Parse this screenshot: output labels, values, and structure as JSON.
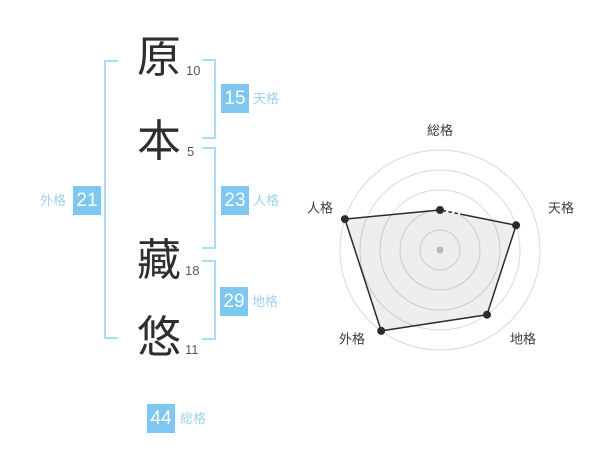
{
  "name_diagram": {
    "characters": [
      {
        "char": "原",
        "strokes": "10"
      },
      {
        "char": "本",
        "strokes": "5"
      },
      {
        "char": "藏",
        "strokes": "18"
      },
      {
        "char": "悠",
        "strokes": "11"
      }
    ],
    "badges": {
      "tenkaku": {
        "value": "15",
        "label": "天格"
      },
      "jinkaku": {
        "value": "23",
        "label": "人格"
      },
      "chikaku": {
        "value": "29",
        "label": "地格"
      },
      "gaikaku": {
        "value": "21",
        "label": "外格"
      },
      "soukaku": {
        "value": "44",
        "label": "総格"
      }
    },
    "colors": {
      "badge": "#7dc7f0",
      "badge_label": "#9fd2f1",
      "bracket": "#a9dcf6",
      "kanji": "#2e2e2e",
      "stroke_count": "#595959"
    }
  },
  "chart_data": {
    "type": "radar",
    "categories": [
      "総格",
      "天格",
      "地格",
      "外格",
      "人格"
    ],
    "values": [
      2,
      4,
      4,
      5,
      5
    ],
    "max": 5,
    "rings": 5,
    "ring_step": 1,
    "grid": "circular",
    "legend": "none",
    "radius_px": 100,
    "ring_color": "#d9d9d9",
    "line_color": "#2b2b2b",
    "point_color": "#2b2b2b",
    "fill_color": "rgba(0,0,0,0.065)",
    "center_dot_color": "#c4c4c4",
    "label_color": "#3b3b3b"
  }
}
